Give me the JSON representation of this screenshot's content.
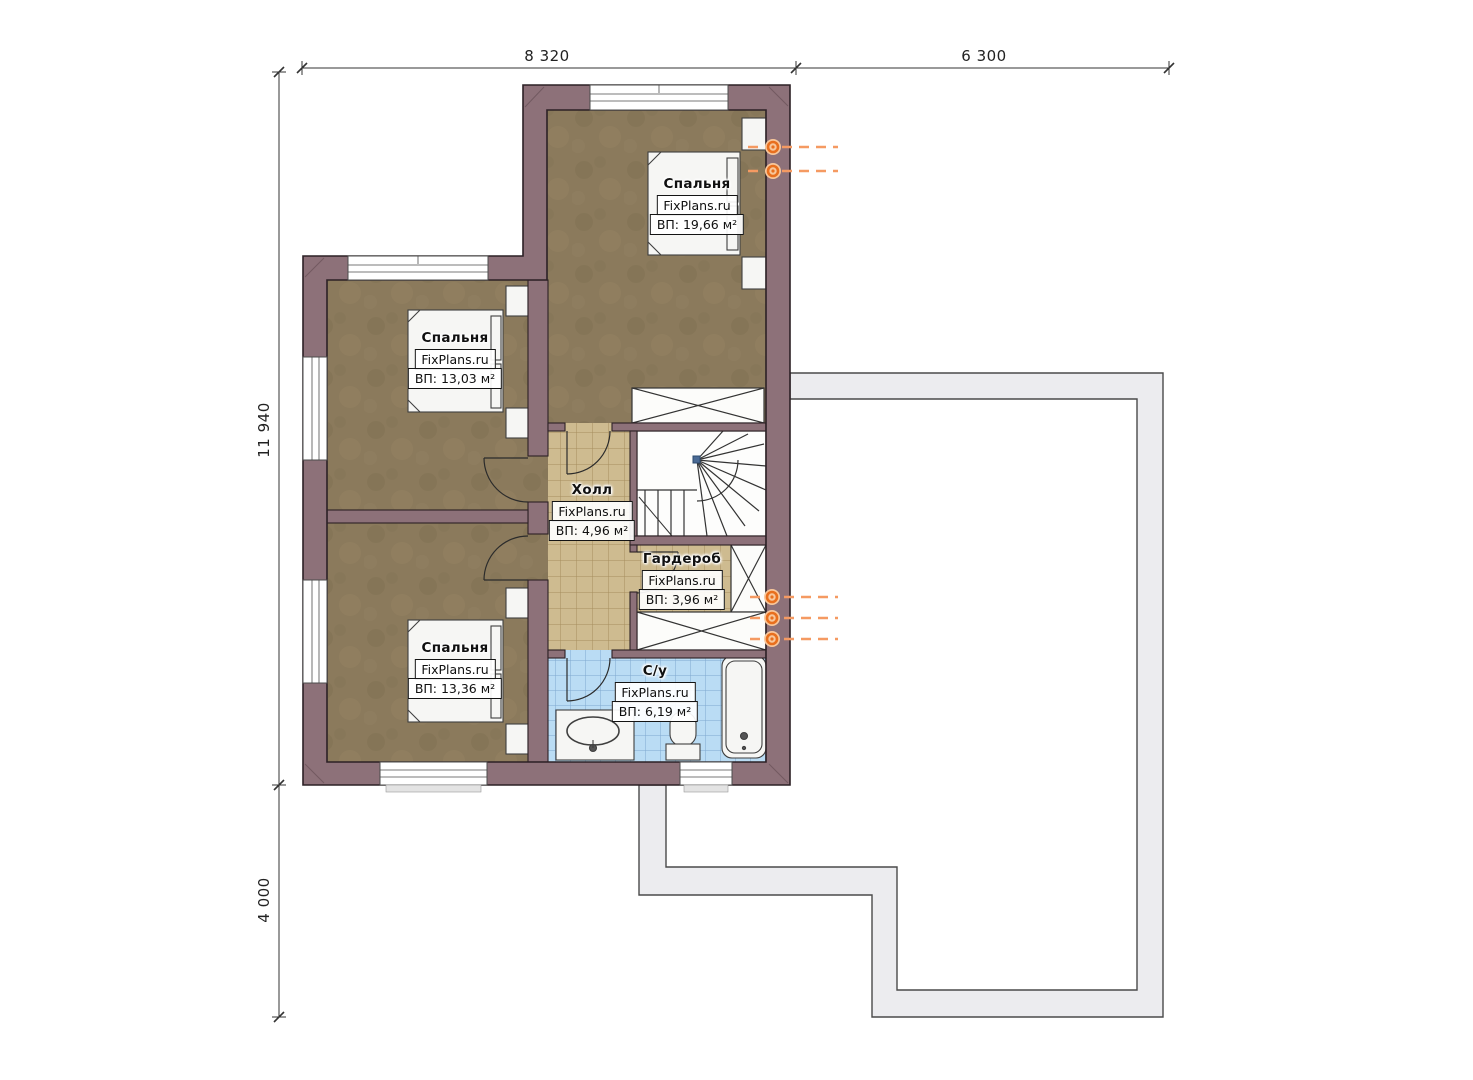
{
  "plan": {
    "brand": "FixPlans.ru",
    "dims": {
      "top_1": "8 320",
      "top_2": "6 300",
      "left_1": "11 940",
      "left_2": "4 000"
    },
    "rooms": [
      {
        "name": "Спальня",
        "brand": "FixPlans.ru",
        "area": "ВП: 19,66 м²"
      },
      {
        "name": "Спальня",
        "brand": "FixPlans.ru",
        "area": "ВП: 13,03 м²"
      },
      {
        "name": "Спальня",
        "brand": "FixPlans.ru",
        "area": "ВП: 13,36 м²"
      },
      {
        "name": "Холл",
        "brand": "FixPlans.ru",
        "area": "ВП: 4,96 м²"
      },
      {
        "name": "Гардероб",
        "brand": "FixPlans.ru",
        "area": "ВП: 3,96 м²"
      },
      {
        "name": "С/у",
        "brand": "FixPlans.ru",
        "area": "ВП: 6,19 м²"
      }
    ],
    "colors": {
      "wall": "#8d7179",
      "carpet": "#8b7a5c",
      "tile_beige": "#cebb90",
      "tile_blue": "#badcf4",
      "terrace": "#ececef",
      "radiator": "#e86f1e"
    }
  }
}
